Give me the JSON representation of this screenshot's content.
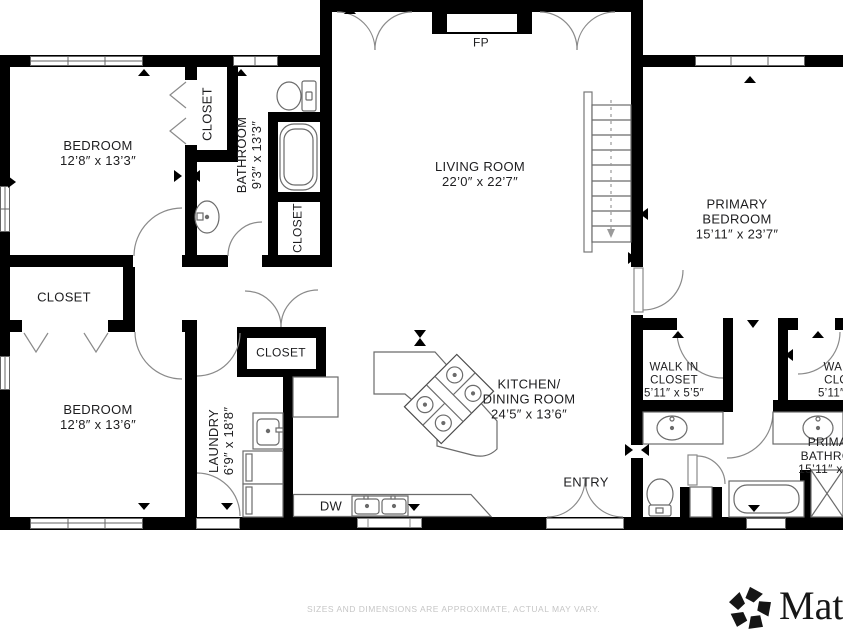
{
  "labels": {
    "bedroom_tl": {
      "name": "BEDROOM",
      "dims": "12’8″ x 13’3″"
    },
    "closet_tl": {
      "name": "CLOSET"
    },
    "bathroom": {
      "name": "BATHROOM",
      "dims": "9’3″ x 13’3″"
    },
    "closet_bath": {
      "name": "CLOSET"
    },
    "living": {
      "name": "LIVING ROOM",
      "dims": "22’0″ x 22’7″"
    },
    "fireplace": {
      "name": "FP"
    },
    "primary_bedroom": {
      "line1": "PRIMARY",
      "line2": "BEDROOM",
      "dims": "15’11″ x 23’7″"
    },
    "closet_mid": {
      "name": "CLOSET"
    },
    "bedroom_bl": {
      "name": "BEDROOM",
      "dims": "12’8″ x 13’6″"
    },
    "laundry": {
      "name": "LAUNDRY",
      "dims": "6’9″ x 18’8″"
    },
    "closet_kitchen": {
      "name": "CLOSET"
    },
    "kitchen": {
      "line1": "KITCHEN/",
      "line2": "DINING ROOM",
      "dims": "24’5″ x 13’6″"
    },
    "dishwasher": {
      "name": "DW"
    },
    "entry": {
      "name": "ENTRY"
    },
    "wic1": {
      "line1": "WALK IN",
      "line2": "CLOSET",
      "dims": "5’11″ x 5’5″"
    },
    "wic2": {
      "line1": "WALK IN",
      "line2": "CLOSET",
      "dims": "5’11″ x 5’5″"
    },
    "primary_bath": {
      "line1": "PRIMARY",
      "line2": "BATHROOM",
      "dims": "15’11″ x 7’11″"
    }
  },
  "footer": {
    "disclaimer": "SIZES AND DIMENSIONS ARE APPROXIMATE, ACTUAL MAY VARY."
  },
  "brand": {
    "name": "Mat"
  }
}
